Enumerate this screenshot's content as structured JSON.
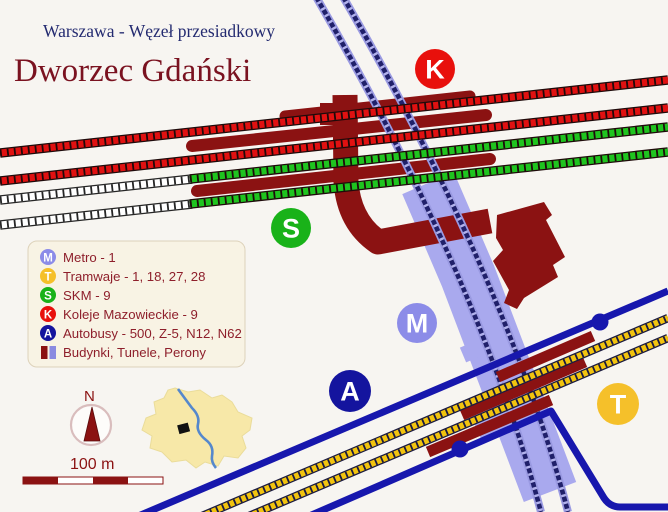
{
  "header": {
    "subtitle": "Warszawa - Węzeł przesiadkowy",
    "title": "Dworzec Gdański"
  },
  "legend": {
    "items": [
      {
        "badge": "M",
        "label": "Metro - 1"
      },
      {
        "badge": "T",
        "label": "Tramwaje - 1, 18, 27, 28"
      },
      {
        "badge": "S",
        "label": "SKM  - 9"
      },
      {
        "badge": "K",
        "label": "Koleje Mazowieckie - 9"
      },
      {
        "badge": "A",
        "label": "Autobusy - 500, Z-5, N12, N62"
      },
      {
        "badge": "",
        "label": "Budynki, Tunele, Perony"
      }
    ]
  },
  "map_badges": {
    "K": "K",
    "S": "S",
    "M": "M",
    "A": "A",
    "T": "T"
  },
  "compass": {
    "north_label": "N"
  },
  "scale": {
    "label": "100 m"
  },
  "colors": {
    "background": "#f7f5f1",
    "buildings_maroon": "#8b1212",
    "title_maroon": "#7a1220",
    "subtitle_navy": "#232a70",
    "rail_red": "#e01111",
    "rail_green": "#1fc41f",
    "rail_uncolored": "#ffffff",
    "metro_band": "#a9a9ee",
    "metro_core": "#20206a",
    "bus_blue": "#1717ad",
    "tram_yellow": "#f2c40f",
    "badge_M": "#8c8ce8",
    "badge_T": "#f5c02a",
    "badge_S": "#19b219",
    "badge_K": "#e8100c",
    "badge_A": "#14149e",
    "legend_bg": "#f8f3e4",
    "inset_land": "#f7e8a8",
    "river_blue": "#5588cc"
  }
}
